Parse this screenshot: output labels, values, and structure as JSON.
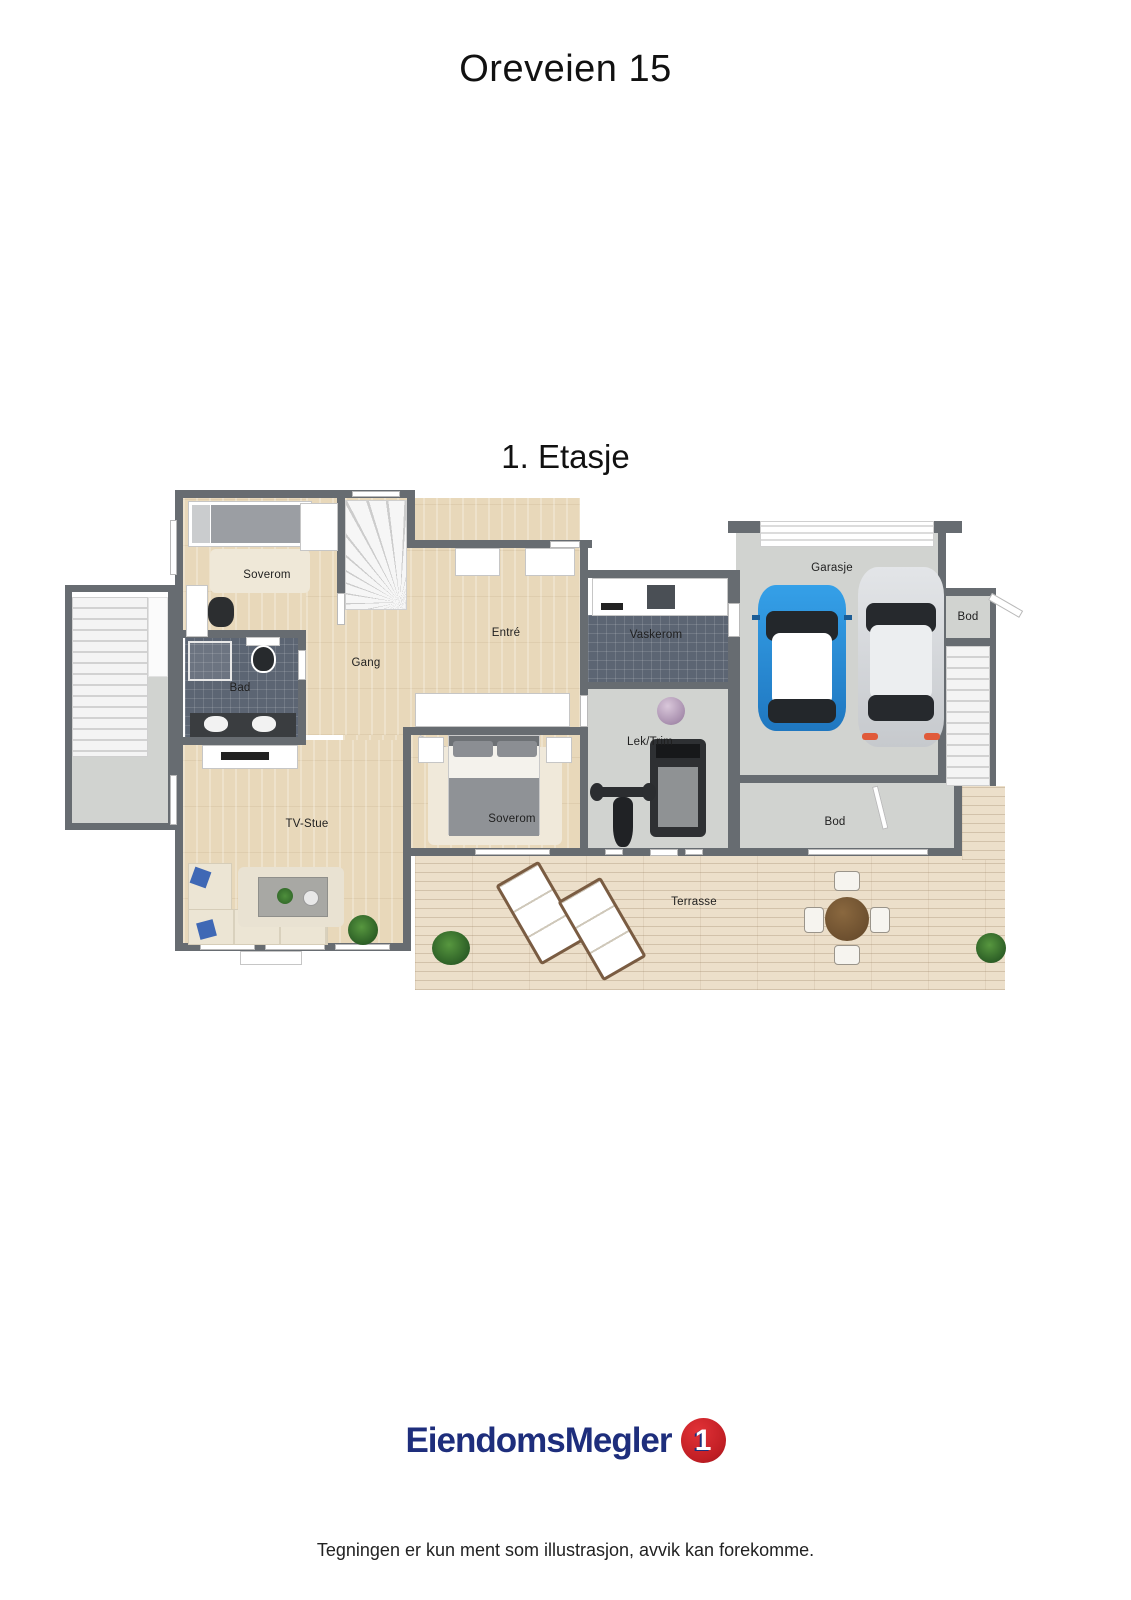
{
  "page": {
    "title": "Oreveien 15",
    "floor_title": "1. Etasje",
    "disclaimer": "Tegningen er kun ment som illustrasjon, avvik kan forekomme."
  },
  "floorplan": {
    "rooms": {
      "soverom_top": "Soverom",
      "bad": "Bad",
      "gang": "Gang",
      "entre": "Entré",
      "vaskerom": "Vaskerom",
      "soverom_mid": "Soverom",
      "tv_stue": "TV-Stue",
      "lek_trim": "Lek/Trim",
      "garasje": "Garasje",
      "bod_right": "Bod",
      "bod_bottom": "Bod",
      "terrasse": "Terrasse"
    }
  },
  "logo": {
    "brand": "EiendomsMegler",
    "badge_number": "1"
  },
  "colors": {
    "wall": "#676c71",
    "wood_floor": "#e8d8ba",
    "tile_floor": "#5c6573",
    "concrete_floor": "#d1d3d0",
    "deck": "#ecdfca",
    "logo_navy": "#1e2e7c",
    "logo_red": "#c01e24",
    "car_blue": "#2e8fd6",
    "car_silver": "#d7d9dc"
  }
}
